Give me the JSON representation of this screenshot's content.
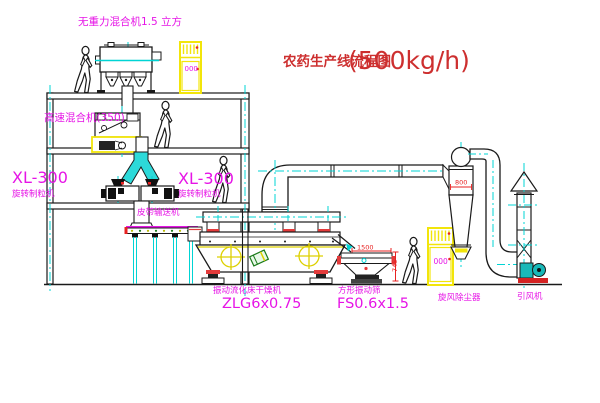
{
  "title": {
    "name_cn": "农药生产线流程图",
    "capacity": "(500kg/h)"
  },
  "equipment": {
    "gravity_mixer": {
      "label": "无重力混合机1.5 立方"
    },
    "high_speed_mixer": {
      "label": "高速混合机(350)"
    },
    "granulator_left": {
      "model": "XL-300",
      "name": "旋转制粒机"
    },
    "granulator_right": {
      "model": "XL-300",
      "name": "旋转制粒机"
    },
    "belt_conveyor": {
      "label": "皮带输送机"
    },
    "fluid_bed_dryer": {
      "name": "振动流化床干燥机",
      "model": "ZLG6x0.75"
    },
    "vibrating_screen": {
      "name": "方形振动筛",
      "model": "FS0.6x1.5",
      "dim_width": "1500",
      "dim_height": "745"
    },
    "cyclone": {
      "name": "旋风除尘器",
      "dim_width": "800"
    },
    "draft_fan": {
      "name": "引风机"
    },
    "control_cabinet_top": {
      "display": "000"
    },
    "control_cabinet_bottom": {
      "display": "000"
    }
  },
  "colors": {
    "label_magenta": "#e614e6",
    "title_red": "#cd2f2f",
    "centerline_cyan": "#00d4d4",
    "cabinet_yellow": "#f2e50a",
    "dimension_red": "#e82222",
    "line_black": "#1a1a1a"
  }
}
